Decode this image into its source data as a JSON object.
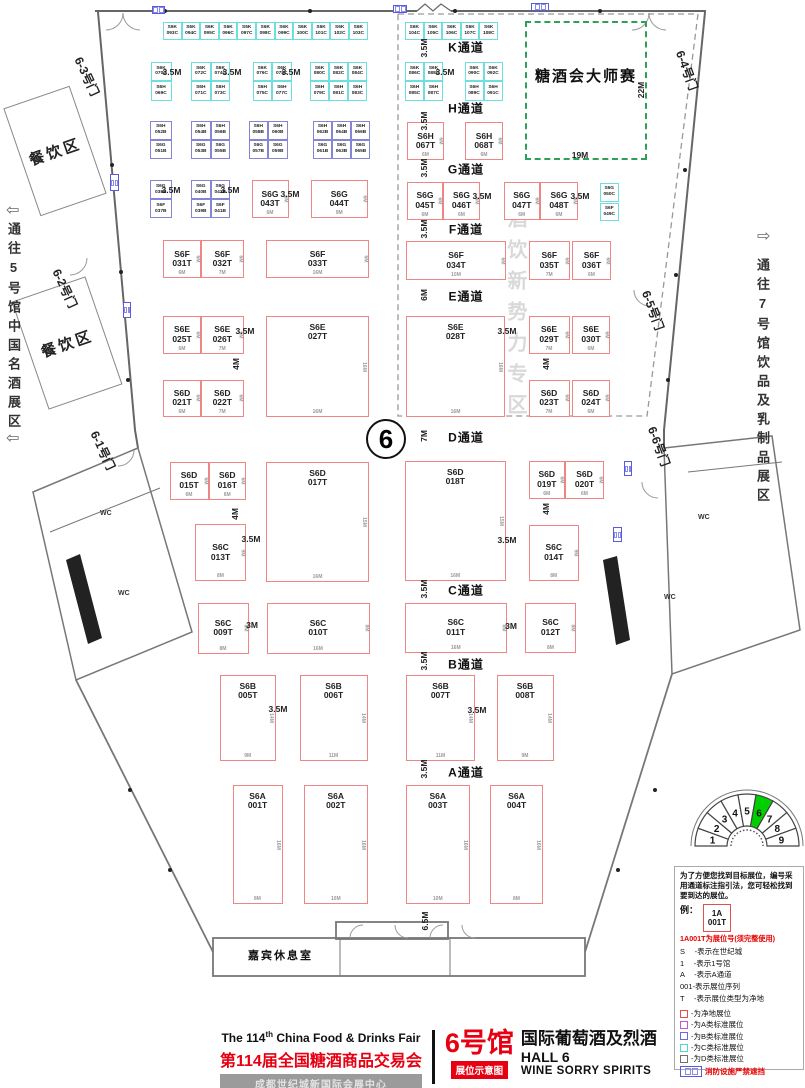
{
  "hall_circle": "6",
  "zones": {
    "master": {
      "label": "糖酒会大师赛"
    },
    "watermark": "酒饮新势力专区",
    "dining": "餐饮区",
    "lounge": "嘉宾休息室",
    "wc": "WC"
  },
  "routes": {
    "left": {
      "arrow": "⇦",
      "text": "通往5号馆中国名酒展区"
    },
    "right": {
      "arrow": "⇨",
      "text": "通往7号馆饮品及乳制品展区"
    }
  },
  "doors": [
    [
      "6-3号门",
      86,
      54,
      65
    ],
    [
      "6-2号门",
      64,
      266,
      65
    ],
    [
      "6-1号门",
      102,
      428,
      65
    ],
    [
      "6-4号门",
      688,
      48,
      70
    ],
    [
      "6-5号门",
      654,
      288,
      70
    ],
    [
      "6-6号门",
      660,
      424,
      70
    ]
  ],
  "aisles": [
    [
      "K通道",
      466,
      47
    ],
    [
      "H通道",
      466,
      108
    ],
    [
      "G通道",
      466,
      169
    ],
    [
      "F通道",
      466,
      229
    ],
    [
      "E通道",
      466,
      296
    ],
    [
      "D通道",
      466,
      437
    ],
    [
      "C通道",
      466,
      590
    ],
    [
      "B通道",
      466,
      664
    ],
    [
      "A通道",
      466,
      772
    ]
  ],
  "booths": [
    [
      "S6K",
      "093C",
      "C",
      163,
      22,
      18.6,
      18
    ],
    [
      "S6K",
      "094C",
      "C",
      181.6,
      22,
      18.6,
      18
    ],
    [
      "S6K",
      "095C",
      "C",
      200.2,
      22,
      18.6,
      18
    ],
    [
      "S6K",
      "096C",
      "C",
      218.8,
      22,
      18.6,
      18
    ],
    [
      "S6K",
      "097C",
      "C",
      237.4,
      22,
      18.6,
      18
    ],
    [
      "S6K",
      "098C",
      "C",
      256,
      22,
      18.6,
      18
    ],
    [
      "S6K",
      "099C",
      "C",
      274.6,
      22,
      18.6,
      18
    ],
    [
      "S6K",
      "100C",
      "C",
      293.2,
      22,
      18.6,
      18
    ],
    [
      "S6K",
      "101C",
      "C",
      311.8,
      22,
      18.6,
      18
    ],
    [
      "S6K",
      "102C",
      "C",
      330.4,
      22,
      18.6,
      18
    ],
    [
      "S6K",
      "103C",
      "C",
      349,
      22,
      18.6,
      18
    ],
    [
      "S6K",
      "104C",
      "C",
      405,
      22,
      18.6,
      18
    ],
    [
      "S6K",
      "105C",
      "C",
      423.6,
      22,
      18.6,
      18
    ],
    [
      "S6K",
      "106C",
      "C",
      442.2,
      22,
      18.6,
      18
    ],
    [
      "S6K",
      "107C",
      "C",
      460.8,
      22,
      18.6,
      18
    ],
    [
      "S6K",
      "108C",
      "C",
      479.4,
      22,
      18.6,
      18
    ],
    [
      "S6K",
      "070C",
      "C",
      150.5,
      61.5,
      21,
      19.5
    ],
    [
      "S6H",
      "069C",
      "C",
      150.5,
      81,
      21,
      19.5
    ],
    [
      "S6K",
      "072C",
      "C",
      191,
      61.5,
      19.5,
      19.5
    ],
    [
      "S6K",
      "074C",
      "C",
      210.5,
      61.5,
      19.5,
      19.5
    ],
    [
      "S6H",
      "071C",
      "C",
      191,
      81,
      19.5,
      19.5
    ],
    [
      "S6H",
      "073C",
      "C",
      210.5,
      81,
      19.5,
      19.5
    ],
    [
      "S6K",
      "076C",
      "C",
      252.5,
      61.5,
      19.5,
      19.5
    ],
    [
      "S6K",
      "078C",
      "C",
      272,
      61.5,
      19.5,
      19.5
    ],
    [
      "S6H",
      "075C",
      "C",
      252.5,
      81,
      19.5,
      19.5
    ],
    [
      "S6H",
      "077C",
      "C",
      272,
      81,
      19.5,
      19.5
    ],
    [
      "S6K",
      "080C",
      "C",
      310,
      61.5,
      19,
      19.5
    ],
    [
      "S6K",
      "082C",
      "C",
      329,
      61.5,
      19,
      19.5
    ],
    [
      "S6K",
      "084C",
      "C",
      348,
      61.5,
      19,
      19.5
    ],
    [
      "S6H",
      "079C",
      "C",
      310,
      81,
      19,
      19.5
    ],
    [
      "S6H",
      "081C",
      "C",
      329,
      81,
      19,
      19.5
    ],
    [
      "S6H",
      "083C",
      "C",
      348,
      81,
      19,
      19.5
    ],
    [
      "S6K",
      "086C",
      "C",
      405,
      61.5,
      19,
      19.5
    ],
    [
      "S6K",
      "088C",
      "C",
      424,
      61.5,
      19,
      19.5
    ],
    [
      "S6H",
      "085C",
      "C",
      405,
      81,
      19,
      19.5
    ],
    [
      "S6H",
      "087C",
      "C",
      424,
      81,
      19,
      19.5
    ],
    [
      "S6K",
      "090C",
      "C",
      464.5,
      61.5,
      19,
      19.5
    ],
    [
      "S6K",
      "092C",
      "C",
      483.5,
      61.5,
      19,
      19.5
    ],
    [
      "S6H",
      "089C",
      "C",
      464.5,
      81,
      19,
      19.5
    ],
    [
      "S6H",
      "091C",
      "C",
      483.5,
      81,
      19,
      19.5
    ],
    [
      "S6H",
      "052B",
      "B",
      150,
      120.5,
      21.5,
      19
    ],
    [
      "S6G",
      "051B",
      "B",
      150,
      139.5,
      21.5,
      19
    ],
    [
      "S6H",
      "054B",
      "B",
      191,
      120.5,
      19.5,
      19
    ],
    [
      "S6H",
      "056B",
      "B",
      210.5,
      120.5,
      19.5,
      19
    ],
    [
      "S6G",
      "053B",
      "B",
      191,
      139.5,
      19.5,
      19
    ],
    [
      "S6G",
      "055B",
      "B",
      210.5,
      139.5,
      19.5,
      19
    ],
    [
      "S6H",
      "058B",
      "B",
      248.5,
      120.5,
      19.5,
      19
    ],
    [
      "S6H",
      "060B",
      "B",
      268,
      120.5,
      19.5,
      19
    ],
    [
      "S6G",
      "057B",
      "B",
      248.5,
      139.5,
      19.5,
      19
    ],
    [
      "S6G",
      "059B",
      "B",
      268,
      139.5,
      19.5,
      19
    ],
    [
      "S6H",
      "062B",
      "B",
      313,
      120.5,
      19,
      19
    ],
    [
      "S6H",
      "064B",
      "B",
      332,
      120.5,
      19,
      19
    ],
    [
      "S6H",
      "066B",
      "B",
      351,
      120.5,
      19,
      19
    ],
    [
      "S6G",
      "061B",
      "B",
      313,
      139.5,
      19,
      19
    ],
    [
      "S6G",
      "063B",
      "B",
      332,
      139.5,
      19,
      19
    ],
    [
      "S6G",
      "065B",
      "B",
      351,
      139.5,
      19,
      19
    ],
    [
      "S6G",
      "038B",
      "B",
      150,
      180,
      21.5,
      19
    ],
    [
      "S6F",
      "037B",
      "B",
      150,
      199,
      21.5,
      19
    ],
    [
      "S6G",
      "040B",
      "B",
      191,
      180,
      19.5,
      19
    ],
    [
      "S6G",
      "042B",
      "B",
      210.5,
      180,
      19.5,
      19
    ],
    [
      "S6F",
      "039B",
      "B",
      191,
      199,
      19.5,
      19
    ],
    [
      "S6F",
      "041B",
      "B",
      210.5,
      199,
      19.5,
      19
    ],
    [
      "S6H",
      "067T",
      "T",
      407,
      122,
      37,
      38,
      "6M",
      "6M"
    ],
    [
      "S6H",
      "068T",
      "T",
      465,
      122,
      38,
      38,
      "6M",
      "6M"
    ],
    [
      "S6G",
      "043T",
      "T",
      251.5,
      180,
      37,
      38,
      "6M",
      "6M"
    ],
    [
      "S6G",
      "044T",
      "T",
      311,
      180,
      56.5,
      38,
      "9M",
      "6M"
    ],
    [
      "S6G",
      "045T",
      "T",
      407,
      181.5,
      36,
      38,
      "6M",
      "6M"
    ],
    [
      "S6G",
      "046T",
      "T",
      443,
      181.5,
      37,
      38,
      "6M",
      "6M"
    ],
    [
      "S6G",
      "047T",
      "T",
      503.5,
      181.5,
      36.5,
      38,
      "6M",
      "6M"
    ],
    [
      "S6G",
      "048T",
      "T",
      540,
      181.5,
      38,
      38,
      "6M",
      "6M"
    ],
    [
      "S6G",
      "050C",
      "C",
      600,
      182.5,
      18.5,
      19
    ],
    [
      "S6F",
      "049C",
      "C",
      600,
      202.5,
      18.5,
      18.5
    ],
    [
      "S6F",
      "031T",
      "T",
      163,
      240,
      38,
      38,
      "6M",
      "6M"
    ],
    [
      "S6F",
      "032T",
      "T",
      201,
      240,
      42.5,
      38,
      "7M",
      "6M"
    ],
    [
      "S6F",
      "033T",
      "T",
      266,
      240,
      103,
      38,
      "16M",
      "6M"
    ],
    [
      "S6F",
      "034T",
      "T",
      406,
      241,
      100,
      39,
      "10M",
      "6M"
    ],
    [
      "S6F",
      "035T",
      "T",
      528.5,
      241,
      41.5,
      39,
      "7M",
      "6M"
    ],
    [
      "S6F",
      "036T",
      "T",
      572,
      241,
      39,
      39,
      "6M",
      "6M"
    ],
    [
      "S6E",
      "025T",
      "T",
      163,
      316,
      38,
      37.5,
      "6M",
      "6M"
    ],
    [
      "S6E",
      "026T",
      "T",
      201,
      316,
      42.5,
      37.5,
      "7M",
      "6M"
    ],
    [
      "S6E",
      "027T",
      "T",
      266,
      316,
      103,
      101,
      "16M",
      "16M"
    ],
    [
      "S6E",
      "028T",
      "T",
      406,
      316,
      99,
      101,
      "16M",
      "16M"
    ],
    [
      "S6E",
      "029T",
      "T",
      528.5,
      316,
      41,
      37.5,
      "7M",
      "6M"
    ],
    [
      "S6E",
      "030T",
      "T",
      572,
      316,
      38,
      37.5,
      "6M",
      "6M"
    ],
    [
      "S6D",
      "021T",
      "T",
      163,
      379.5,
      38,
      37,
      "6M",
      "6M"
    ],
    [
      "S6D",
      "022T",
      "T",
      201,
      379.5,
      42.5,
      37,
      "7M",
      "6M"
    ],
    [
      "S6D",
      "023T",
      "T",
      528.5,
      379.5,
      41,
      37,
      "7M",
      "6M"
    ],
    [
      "S6D",
      "024T",
      "T",
      572,
      379.5,
      38,
      37,
      "6M",
      "6M"
    ],
    [
      "S6D",
      "015T",
      "T",
      169.5,
      461.5,
      39,
      38.5,
      "6M",
      "6M"
    ],
    [
      "S6D",
      "016T",
      "T",
      208.5,
      461.5,
      37.5,
      38.5,
      "6M",
      "6M"
    ],
    [
      "S6D",
      "017T",
      "T",
      266,
      461.5,
      103,
      120,
      "16M",
      "15M"
    ],
    [
      "S6D",
      "018T",
      "T",
      405,
      461,
      100.5,
      120,
      "16M",
      "15M"
    ],
    [
      "S6D",
      "019T",
      "T",
      528.5,
      461,
      36.5,
      37.5,
      "6M",
      "6M"
    ],
    [
      "S6D",
      "020T",
      "T",
      565,
      461,
      39,
      37.5,
      "6M",
      "6M"
    ],
    [
      "S6C",
      "013T",
      "T",
      195,
      524,
      51,
      57,
      "8M",
      "9M"
    ],
    [
      "S6C",
      "014T",
      "T",
      528.5,
      524.5,
      50.5,
      56.5,
      "8M",
      "9M"
    ],
    [
      "S6C",
      "009T",
      "T",
      197.5,
      602.5,
      51,
      51,
      "8M",
      "8M"
    ],
    [
      "S6C",
      "010T",
      "T",
      266.5,
      602.5,
      103,
      51,
      "16M",
      "8M"
    ],
    [
      "S6C",
      "011T",
      "T",
      405,
      602.5,
      101.5,
      50,
      "16M",
      "8M"
    ],
    [
      "S6C",
      "012T",
      "T",
      525,
      602.5,
      51,
      50,
      "8M",
      "8M"
    ],
    [
      "S6B",
      "005T",
      "T",
      219.5,
      675,
      56.5,
      86,
      "9M",
      "14M"
    ],
    [
      "S6B",
      "006T",
      "T",
      299.5,
      675,
      68,
      86,
      "11M",
      "14M"
    ],
    [
      "S6B",
      "007T",
      "T",
      406,
      675,
      69,
      86,
      "11M",
      "14M"
    ],
    [
      "S6B",
      "008T",
      "T",
      496.5,
      675,
      57,
      86,
      "9M",
      "14M"
    ],
    [
      "S6A",
      "001T",
      "T",
      232.5,
      785,
      50,
      119,
      "8M",
      "16M"
    ],
    [
      "S6A",
      "002T",
      "T",
      304,
      785,
      63.5,
      119,
      "10M",
      "16M"
    ],
    [
      "S6A",
      "003T",
      "T",
      406,
      785,
      63.5,
      119,
      "10M",
      "16M"
    ],
    [
      "S6A",
      "004T",
      "T",
      490,
      785,
      53,
      119,
      "8M",
      "16M"
    ]
  ],
  "dims": [
    [
      "3.5M",
      172,
      72,
      0
    ],
    [
      "3.5M",
      232,
      72,
      0
    ],
    [
      "3.5M",
      291,
      72,
      0
    ],
    [
      "3.5M",
      445,
      72,
      0
    ],
    [
      "3.5M",
      171,
      190,
      0
    ],
    [
      "3.5M",
      230,
      190,
      0
    ],
    [
      "3.5M",
      290,
      194,
      0
    ],
    [
      "3.5M",
      482,
      196,
      0
    ],
    [
      "3.5M",
      580,
      196,
      0
    ],
    [
      "3.5M",
      245,
      331,
      0
    ],
    [
      "3.5M",
      507,
      331,
      0
    ],
    [
      "4M",
      236,
      364,
      90
    ],
    [
      "4M",
      546,
      364,
      90
    ],
    [
      "4M",
      235,
      514,
      90
    ],
    [
      "4M",
      546,
      509,
      90
    ],
    [
      "3.5M",
      424,
      48,
      90
    ],
    [
      "3.5M",
      424,
      121,
      90
    ],
    [
      "3.5M",
      424,
      168,
      90
    ],
    [
      "3.5M",
      424,
      229,
      90
    ],
    [
      "6M",
      424,
      295,
      90
    ],
    [
      "7M",
      424,
      436,
      90
    ],
    [
      "3.5M",
      251,
      539,
      0
    ],
    [
      "3.5M",
      507,
      540,
      0
    ],
    [
      "3M",
      252,
      625,
      0
    ],
    [
      "3M",
      511,
      626,
      0
    ],
    [
      "3.5M",
      424,
      589,
      90
    ],
    [
      "3.5M",
      424,
      661,
      90
    ],
    [
      "3.5M",
      424,
      769,
      90
    ],
    [
      "3.5M",
      278,
      709,
      0
    ],
    [
      "3.5M",
      477,
      710,
      0
    ],
    [
      "6.5M",
      425,
      921,
      90
    ],
    [
      "22M",
      641,
      90,
      90
    ],
    [
      "19M",
      580,
      155,
      0
    ]
  ],
  "wc_labels": [
    [
      100,
      510
    ],
    [
      118,
      590
    ],
    [
      698,
      514
    ],
    [
      664,
      594
    ]
  ],
  "dining_boxes": [
    [
      20,
      94,
      68,
      112,
      -19
    ],
    [
      28,
      286,
      76,
      112,
      -19
    ]
  ],
  "hydrants": [
    [
      152,
      6,
      13,
      8
    ],
    [
      393,
      5,
      14,
      8
    ],
    [
      531,
      3,
      18,
      8
    ],
    [
      110,
      174,
      9,
      17
    ],
    [
      123,
      302,
      8,
      16
    ],
    [
      624,
      461,
      8,
      15
    ],
    [
      613,
      527,
      9,
      15
    ]
  ],
  "legend": {
    "intro": "为了方便您找到目标展位，编号采用通道标注指引法，您可轻松找到要到达的展位。",
    "example_label": "例：",
    "example_box": {
      "line1": "1A",
      "line2": "001T"
    },
    "example_note": "1A001T为展位号(须完整使用)",
    "keys": [
      "S　 -表示在世纪城",
      "1　 -表示1号馆",
      "A　 -表示A通道",
      "001-表示展位序列",
      "T　 -表示展位类型为净地"
    ],
    "swatches": [
      {
        "color": "#e05050",
        "label": "-为净地展位"
      },
      {
        "color": "#cc55cc",
        "label": "-为A类标准展位"
      },
      {
        "color": "#6a6ad8",
        "label": "-为B类标准展位"
      },
      {
        "color": "#55d5d5",
        "label": "-为C类标准展位"
      },
      {
        "color": "#707070",
        "label": "-为D类标准展位"
      }
    ],
    "fire_note": "消防设施严禁遮挡"
  },
  "title_block": {
    "en_pre": "The 114",
    "en_sup": "th",
    "en_post": " China Food & Drinks Fair",
    "cn": "第114届全国糖酒商品交易会",
    "venue": "成都世纪城新国际会展中心",
    "hall_cn": "6号馆",
    "hall_desc": "国际葡萄酒及烈酒",
    "hall_en": "HALL 6",
    "hall_sub": "WINE SORRY SPIRITS",
    "badge": "展位示意图"
  },
  "minimap": {
    "halls": [
      "1",
      "2",
      "3",
      "4",
      "5",
      "6",
      "7",
      "8",
      "9"
    ],
    "active": "6",
    "active_color": "#00d000"
  }
}
